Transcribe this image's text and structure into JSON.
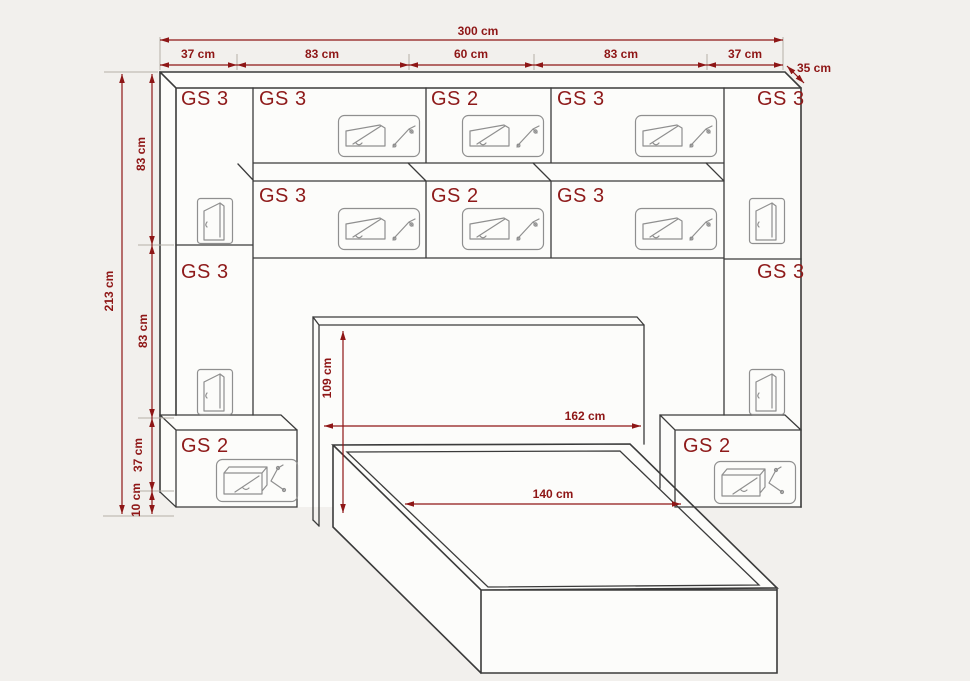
{
  "drawing": {
    "title": "bedroom wall unit with overbed storage and bed - dimensioned drawing",
    "unit_labels": {
      "top_row": [
        "GS 3",
        "GS 3",
        "GS 2",
        "GS 3",
        "GS 3"
      ],
      "middle_row": [
        "GS 3",
        "GS 2",
        "GS 3"
      ],
      "left_column": "GS 3",
      "right_column": "GS 3",
      "left_bedside": "GS 2",
      "right_bedside": "GS 2"
    },
    "dimensions": {
      "total_width": "300 cm",
      "top_segments": [
        "37 cm",
        "83 cm",
        "60 cm",
        "83 cm",
        "37 cm"
      ],
      "depth": "35 cm",
      "total_height": "213 cm",
      "side_segments": [
        "83 cm",
        "83 cm",
        "37 cm",
        "10 cm"
      ],
      "headboard_height": "109 cm",
      "headboard_width": "162 cm",
      "bed_width": "140 cm"
    },
    "colors": {
      "dimension": "#8e1616",
      "label": "#8e1a1a",
      "line": "#3b3b3b",
      "icon": "#8f8f8f",
      "background": "#f2f0ed",
      "face": "#fcfcfa"
    }
  }
}
